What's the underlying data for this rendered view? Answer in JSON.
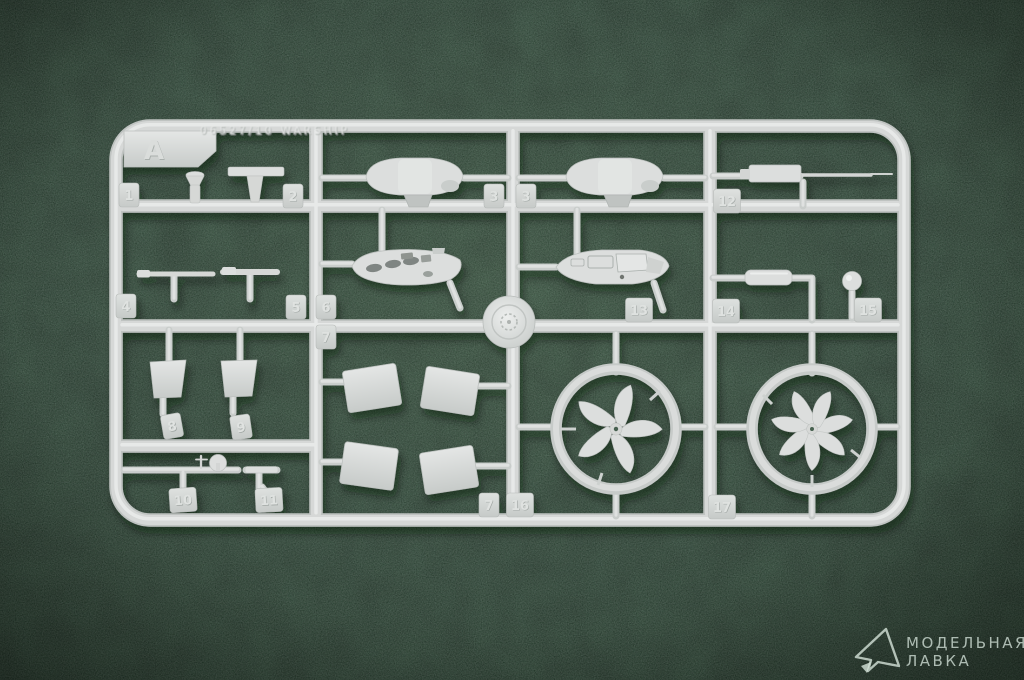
{
  "sprue": {
    "letter": "A",
    "embossed_code": "06527/10 WARSHIP",
    "part_tags": [
      {
        "label": "1"
      },
      {
        "label": "2"
      },
      {
        "label": "3"
      },
      {
        "label": "3"
      },
      {
        "label": "12"
      },
      {
        "label": "4"
      },
      {
        "label": "5"
      },
      {
        "label": "6"
      },
      {
        "label": "7"
      },
      {
        "label": "13"
      },
      {
        "label": "14"
      },
      {
        "label": "15"
      },
      {
        "label": "8"
      },
      {
        "label": "9"
      },
      {
        "label": "10"
      },
      {
        "label": "11"
      },
      {
        "label": "7"
      },
      {
        "label": "16"
      },
      {
        "label": "17"
      }
    ],
    "colors": {
      "felt_green": "#3c5c48",
      "plastic_gray": "#d6d8d6"
    }
  },
  "watermark": {
    "line1": "МОДЕЛЬНАЯ",
    "line2": "ЛАВКА"
  }
}
